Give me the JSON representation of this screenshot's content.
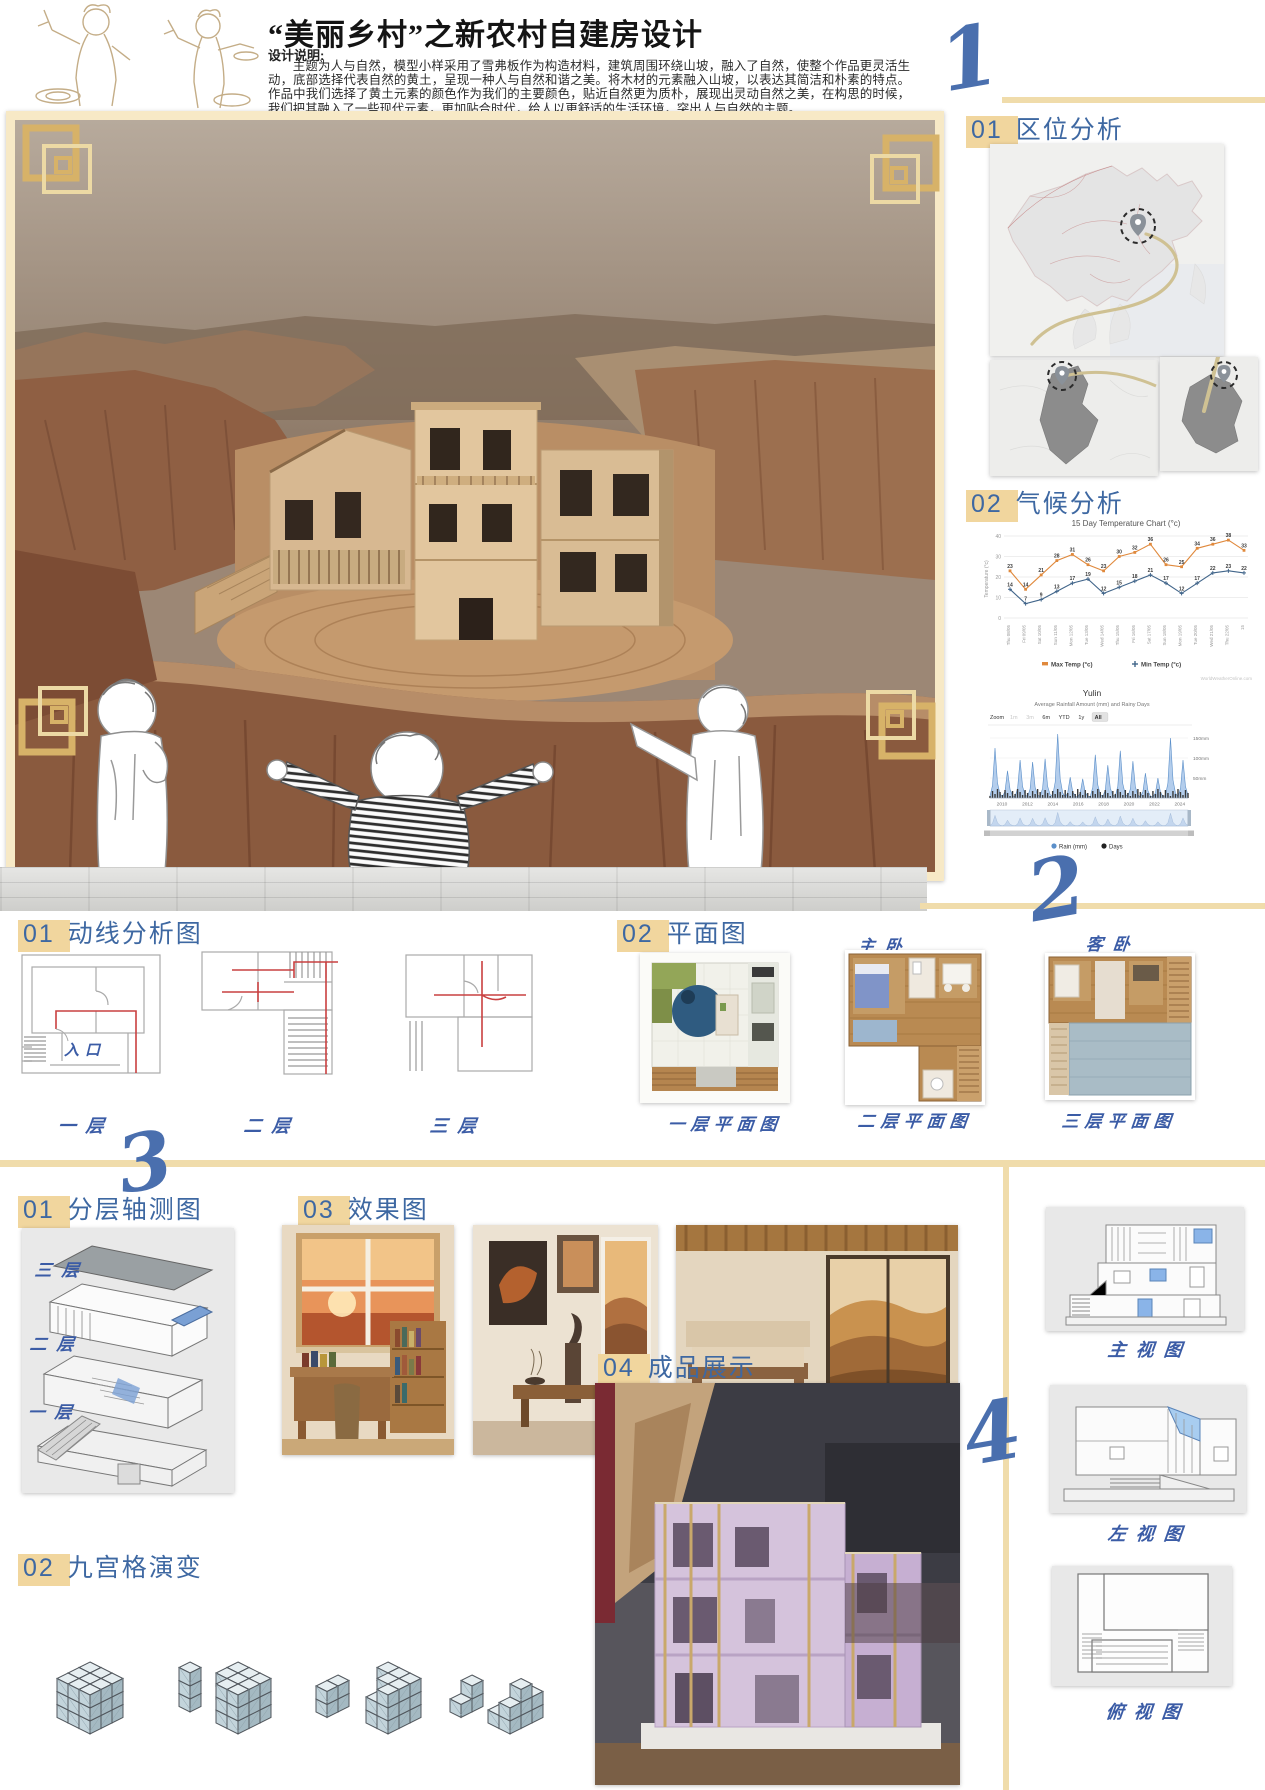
{
  "page": {
    "title": "“美丽乡村”之新农村自建房设计",
    "design_note_label": "设计说明:",
    "design_note": "主题为人与自然，模型小样采用了雪弗板作为构造材料，建筑周围环绕山坡，融入了自然，使整个作品更灵活生动，底部选择代表自然的黄土，呈现一种人与自然和谐之美。将木材的元素融入山坡，以表达其简洁和朴素的特点。作品中我们选择了黄土元素的颜色作为我们的主要颜色，贴近自然更为质朴，展现出灵动自然之美，在构思的时候，我们把其融入了一些现代元素，更加贴合时代，给人以更舒适的生活环境，突出人与自然的主题。",
    "section_numbers": {
      "n1": "1",
      "n2": "2",
      "n3": "3",
      "n4": "4"
    }
  },
  "sections": {
    "location": {
      "num": "01",
      "title": "区位分析"
    },
    "climate": {
      "num": "02",
      "title": "气候分析"
    },
    "circulation": {
      "num": "01",
      "title": "动线分析图",
      "entrance_label": "入口",
      "floors": [
        "一层",
        "二层",
        "三层"
      ]
    },
    "plans": {
      "num": "02",
      "title": "平面图",
      "room_labels": {
        "master": "主卧",
        "guest": "客卧"
      },
      "captions": [
        "一层平面图",
        "二层平面图",
        "三层平面图"
      ]
    },
    "axon": {
      "num": "01",
      "title": "分层轴测图",
      "floors": [
        "三层",
        "二层",
        "一层"
      ]
    },
    "renders": {
      "num": "03",
      "title": "效果图"
    },
    "grid": {
      "num": "02",
      "title": "九宫格演变"
    },
    "product": {
      "num": "04",
      "title": "成品展示"
    },
    "views": {
      "front": "主视图",
      "left": "左视图",
      "top": "俯视图"
    }
  },
  "colors": {
    "accent_blue": "#3e68a2",
    "script_blue": "#4a6fae",
    "highlight_yellow": "#f1d69e",
    "line_yellow": "#f0dcab",
    "max_temp_orange": "#e0893c",
    "min_temp_blue": "#41658a",
    "rain_blue": "#a9c7e8"
  },
  "chart_data": [
    {
      "type": "line",
      "title": "15 Day Temperature Chart (°c)",
      "ylabel": "Temperature (°c)",
      "ylim": [
        0,
        40
      ],
      "yticks": [
        0,
        10,
        20,
        30,
        40
      ],
      "categories": [
        "Thu 08/05",
        "Fri 09/05",
        "Sat 10/05",
        "Sun 11/05",
        "Mon 12/05",
        "Tue 13/05",
        "Wed 14/05",
        "Thu 15/05",
        "Fri 16/05",
        "Sat 17/05",
        "Sun 18/05",
        "Mon 19/05",
        "Tue 20/05",
        "Wed 21/05",
        "Thu 22/05",
        "15"
      ],
      "series": [
        {
          "name": "Max Temp (°c)",
          "color": "#e0893c",
          "values": [
            23,
            14,
            21,
            28,
            31,
            26,
            23,
            30,
            32,
            36,
            26,
            25,
            34,
            36,
            38,
            33
          ]
        },
        {
          "name": "Min Temp (°c)",
          "color": "#41658a",
          "values": [
            14,
            7,
            9,
            13,
            17,
            19,
            12,
            15,
            18,
            21,
            17,
            12,
            17,
            22,
            23,
            22
          ]
        }
      ],
      "legend_position": "bottom",
      "grid": true,
      "watermark": "WorldWeatherOnline.com"
    },
    {
      "type": "area",
      "title": "Yulin",
      "subtitle": "Average Rainfall Amount (mm) and Rainy Days",
      "zoom_label": "Zoom",
      "zoom_buttons": [
        "1m",
        "3m",
        "6m",
        "YTD",
        "1y",
        "All"
      ],
      "active_zoom": "All",
      "disabled_zoom": [
        "1m",
        "3m"
      ],
      "ytick_labels": [
        "150mm",
        "100mm",
        "50mm"
      ],
      "years": [
        "2010",
        "2012",
        "2014",
        "2016",
        "2018",
        "2020",
        "2022",
        "2024"
      ],
      "legend": [
        "Rain (mm)",
        "Days"
      ],
      "annual_peak_rain_mm": [
        125,
        68,
        95,
        90,
        98,
        160,
        52,
        48,
        108,
        82,
        118,
        92,
        62,
        50,
        150,
        95
      ]
    }
  ]
}
